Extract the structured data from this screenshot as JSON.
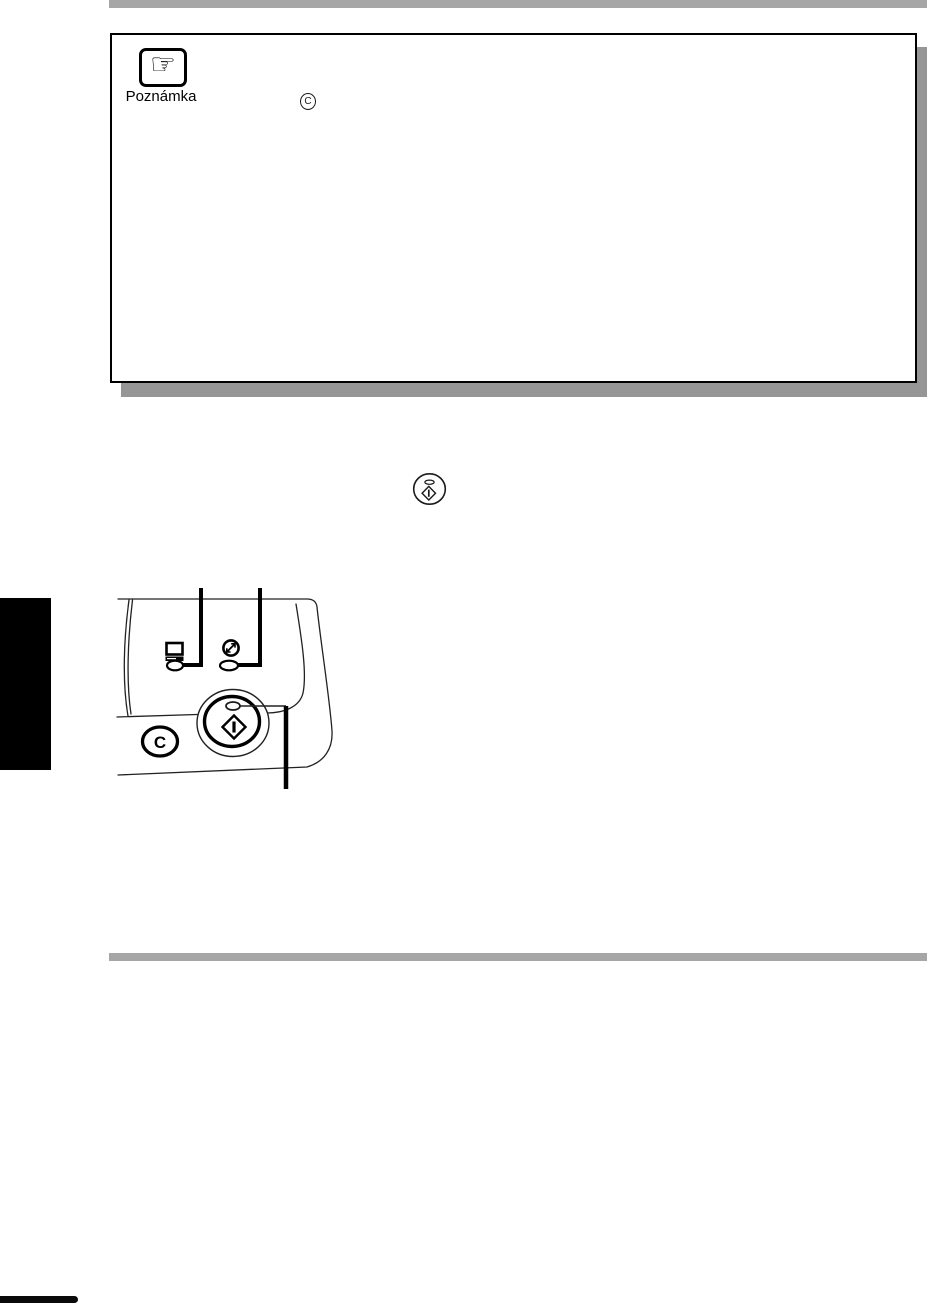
{
  "colors": {
    "bar_gray": "#a6a6a6",
    "shadow_gray": "#969696",
    "ink": "#000000"
  },
  "note_box": {
    "icon_name": "pointing-hand-icon",
    "icon_glyph": "☞",
    "label": "Poznámka",
    "clear_key": {
      "icon_name": "clear-key-circle-icon",
      "letter": "C"
    }
  },
  "inline_start_key": {
    "icon_name": "start-key-icon"
  },
  "figure": {
    "name": "control-panel-diagram",
    "clear_button": {
      "letter": "C"
    },
    "parts": [
      "data-indicator-icon",
      "data-indicator-lamp",
      "energy-save-indicator-icon",
      "energy-save-indicator-lamp",
      "start-button",
      "start-lamp",
      "clear-button",
      "callout-lines",
      "panel-outline"
    ]
  }
}
